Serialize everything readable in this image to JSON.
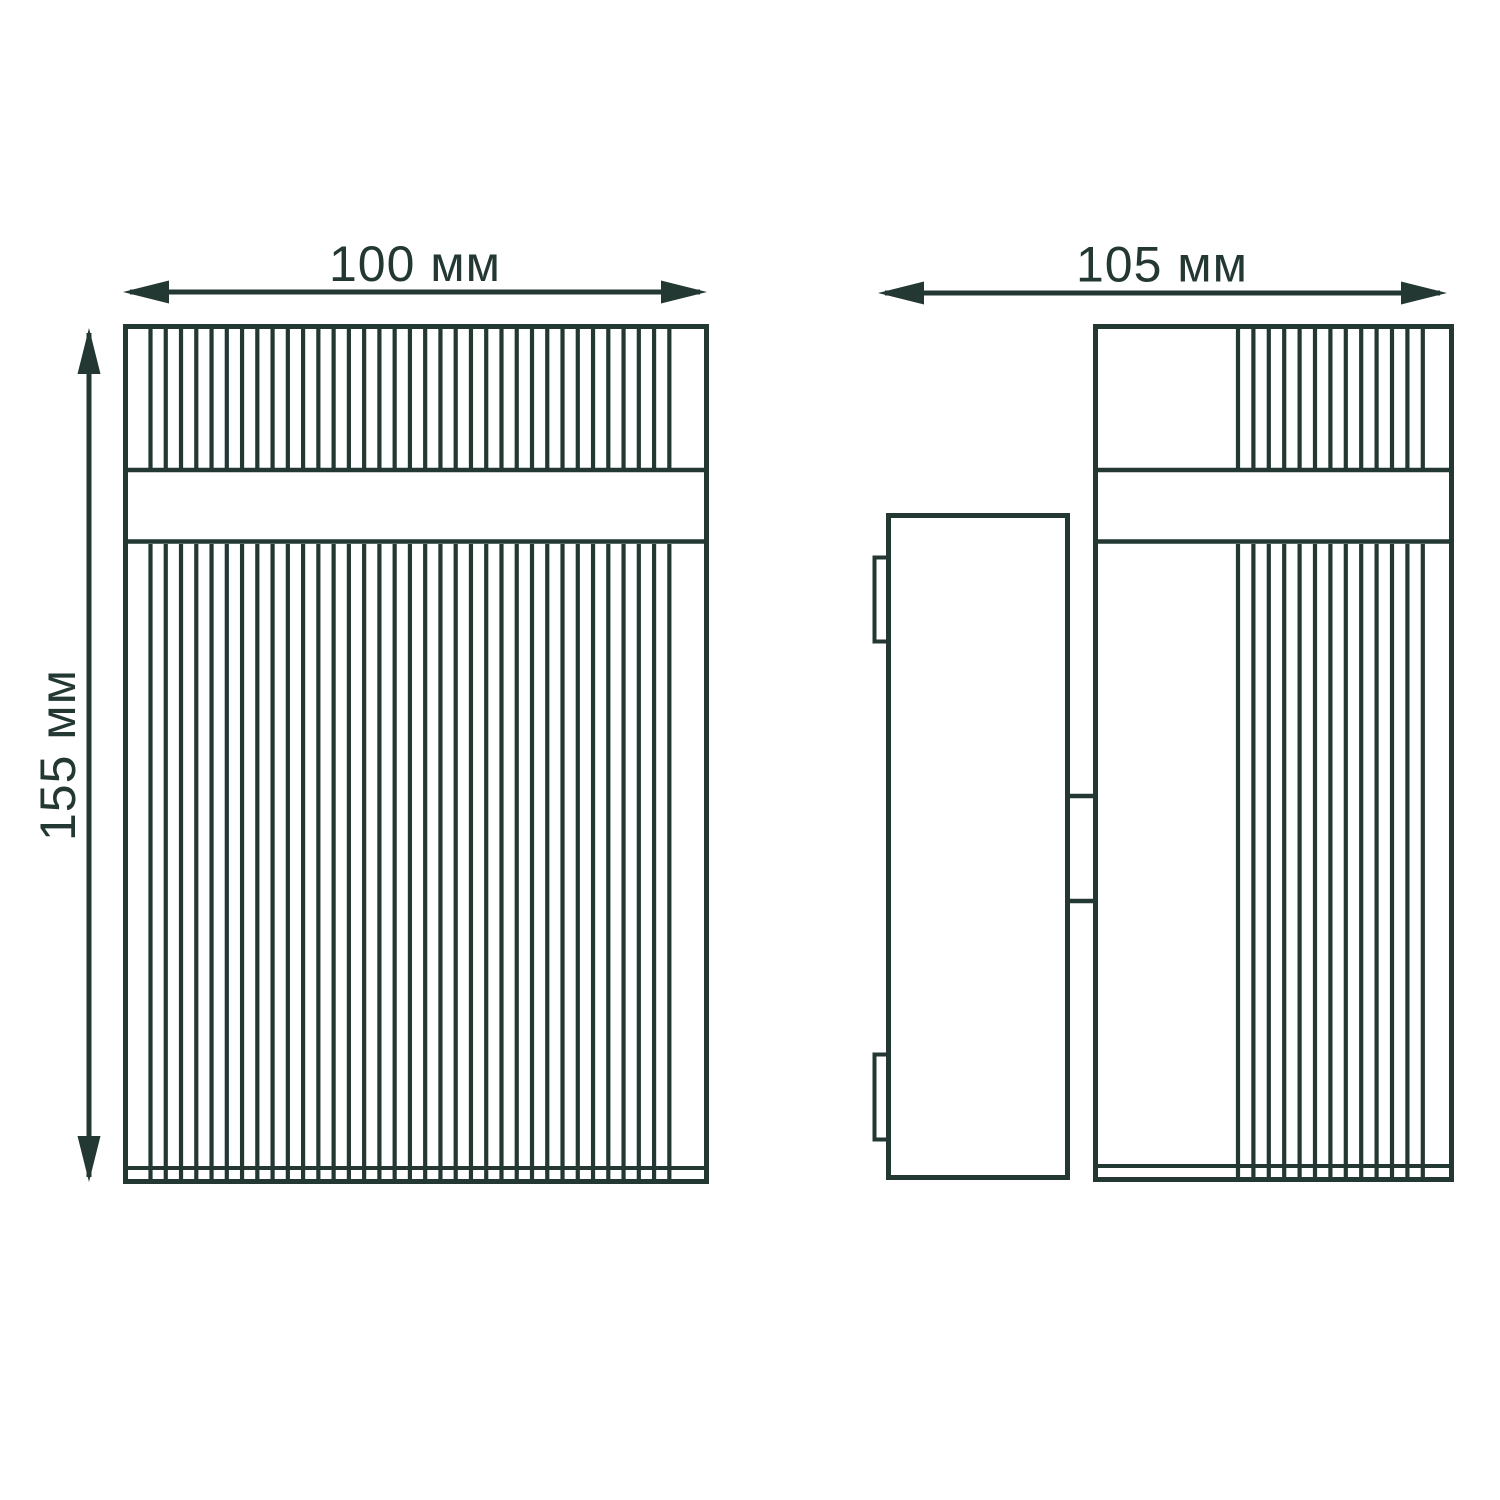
{
  "dimensions": {
    "front_width_label": "100 мм",
    "front_height_label": "155 мм",
    "side_depth_label": "105 мм"
  },
  "colors": {
    "line": "#233733",
    "background": "#ffffff"
  }
}
